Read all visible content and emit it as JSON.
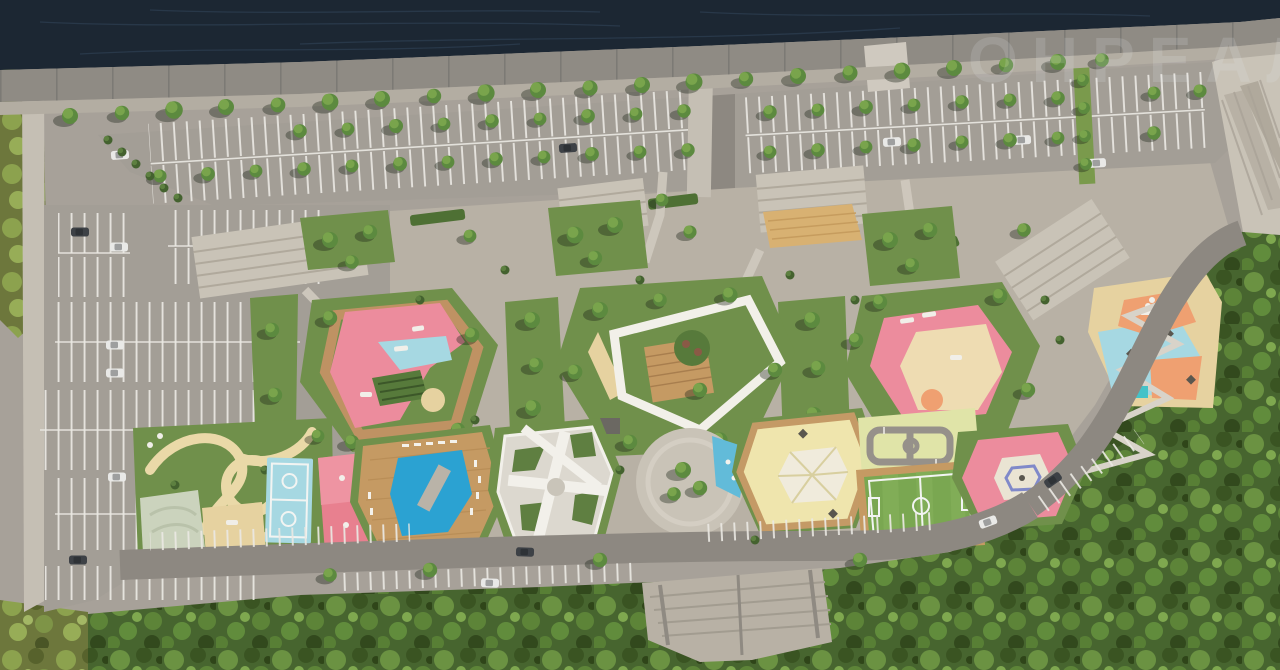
{
  "meta": {
    "view": "aerial-masterplan-render",
    "description": "Bird's-eye architectural rendering of a riverside park: river and embankment promenade at top, tree-lined parking lots, central landscaped courtyards with colorful playgrounds, pool and sports courts, forest belt at bottom and right"
  },
  "watermark": {
    "text": "ОНРЕАЛТ",
    "color": "#e6eaef"
  },
  "palette": {
    "water": "#1c2733",
    "water_ripple": "#33465c",
    "pavement": "#a7a199",
    "plaza": "#b8b1a5",
    "lot": "#a39e96",
    "promenade": "#8f8b84",
    "boardwalk": "#b3ada2",
    "sidewalk": "#c5bfb4",
    "road": "#8d8881",
    "stair": "#c9c3b7",
    "lawn": "#70904b",
    "lawn_dark": "#577a3b",
    "hedge": "#4e7034",
    "wood": "#c59a63",
    "wood_light": "#d8b172",
    "pink": "#ec8c9d",
    "pink_court": "#e8808f",
    "salmon": "#efa071",
    "blue_court": "#a6d8e2",
    "blue_pool": "#2ba2d2",
    "blue_splash": "#62bbd9",
    "sand": "#e6d2a0",
    "yellow": "#efe5ad",
    "yellow_green": "#e0e4a8",
    "sage": "#cbd3bd",
    "turf": "#7aa751",
    "white_deck": "#dcd8cf",
    "white": "#f2f0ea",
    "car_white": "#e9e9e7",
    "car_dark": "#3d4146"
  },
  "features": [
    "river",
    "embankment-promenade",
    "riverside-boardwalk",
    "north-parking-west",
    "north-parking-east",
    "west-parking",
    "northeast-plaza",
    "central-plaza",
    "courtyard-playground-west",
    "central-courtyard-amphitheater",
    "courtyard-playground-east",
    "multicolor-playground-east",
    "play-lawn-block",
    "basketball-court",
    "pink-court",
    "swimming-pool-deck",
    "white-pavilion-deck",
    "round-plaza",
    "yellow-playground",
    "kids-traffic-town",
    "soccer-field",
    "hex-court-pink",
    "switchback-ramp",
    "south-street",
    "east-road",
    "street-parking",
    "entrance-stairs",
    "forest-belt"
  ]
}
